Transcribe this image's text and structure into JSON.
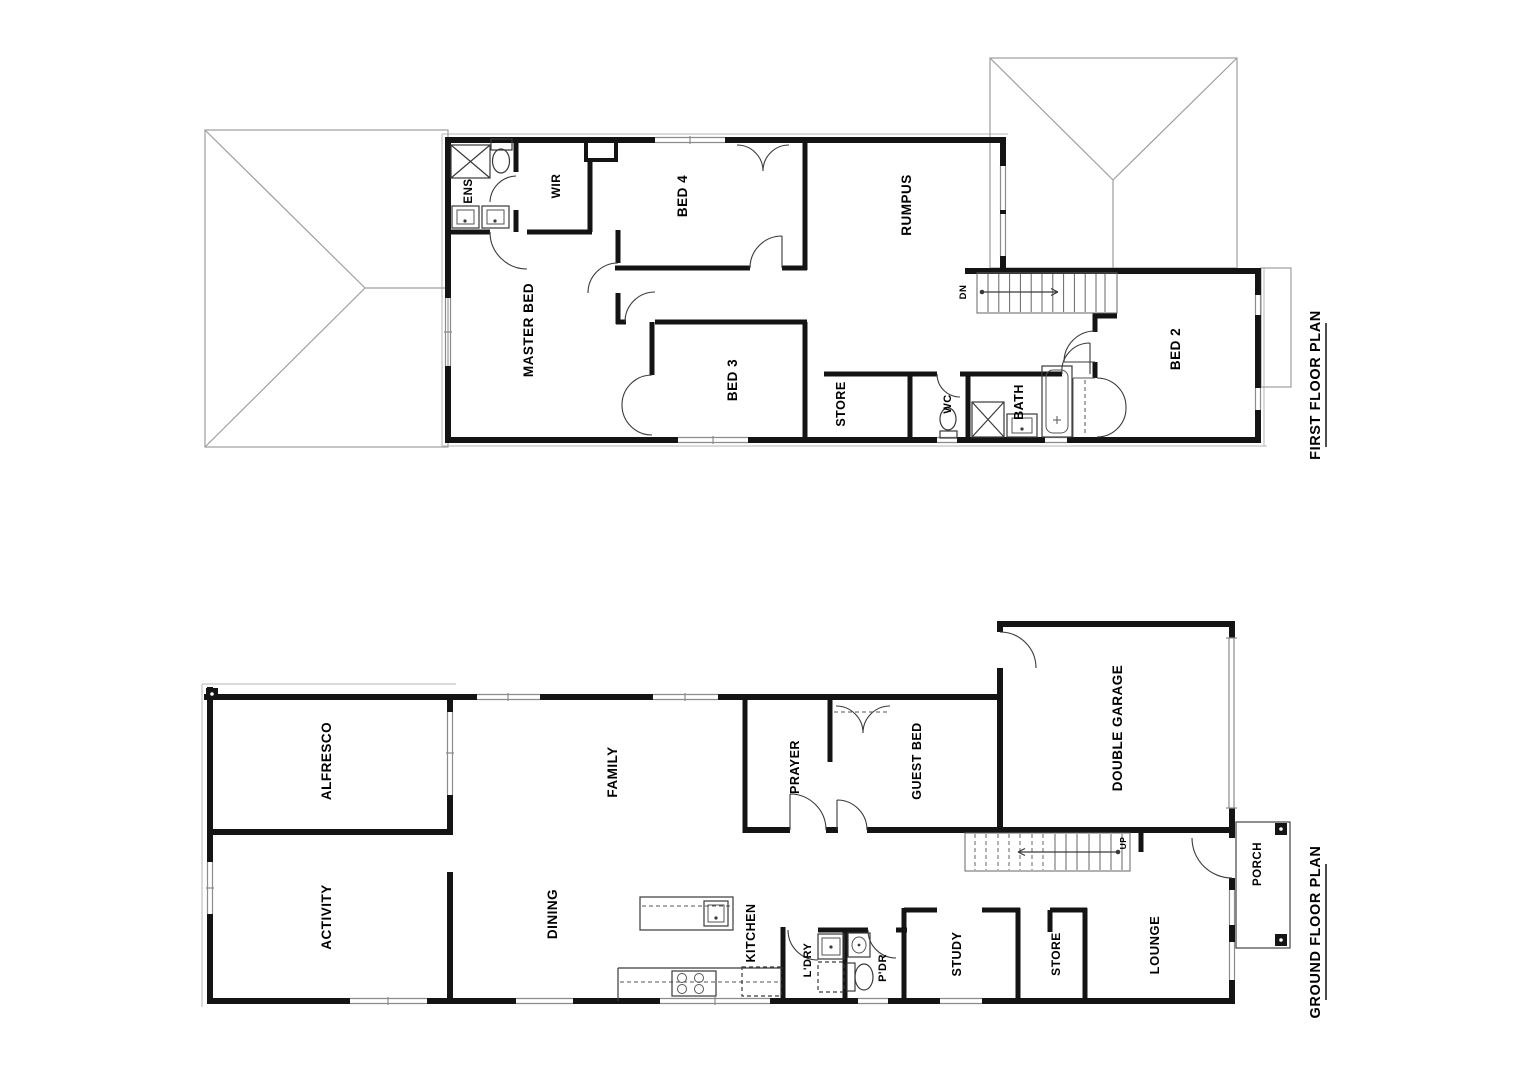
{
  "first_floor": {
    "title": "FIRST FLOOR PLAN",
    "stair_label": "DN",
    "rooms": {
      "ens": "ENS",
      "wir": "WIR",
      "master_bed": "MASTER BED",
      "bed4": "BED 4",
      "rumpus": "RUMPUS",
      "bed3": "BED 3",
      "store": "STORE",
      "wc": "WC",
      "bath": "BATH",
      "bed2": "BED 2"
    }
  },
  "ground_floor": {
    "title": "GROUND FLOOR PLAN",
    "stair_label": "UP",
    "rooms": {
      "alfresco": "ALFRESCO",
      "activity": "ACTIVITY",
      "family": "FAMILY",
      "dining": "DINING",
      "kitchen": "KITCHEN",
      "prayer": "PRAYER",
      "guest_bed": "GUEST BED",
      "laundry": "L'DRY",
      "powder": "P'DR",
      "study": "STUDY",
      "store": "STORE",
      "double_garage": "DOUBLE GARAGE",
      "lounge": "LOUNGE",
      "porch": "PORCH"
    }
  },
  "colors": {
    "wall": "#141414",
    "roof_line": "#9e9e9e",
    "window_line": "#8c8c8c",
    "door_line": "#3a3a3a"
  }
}
